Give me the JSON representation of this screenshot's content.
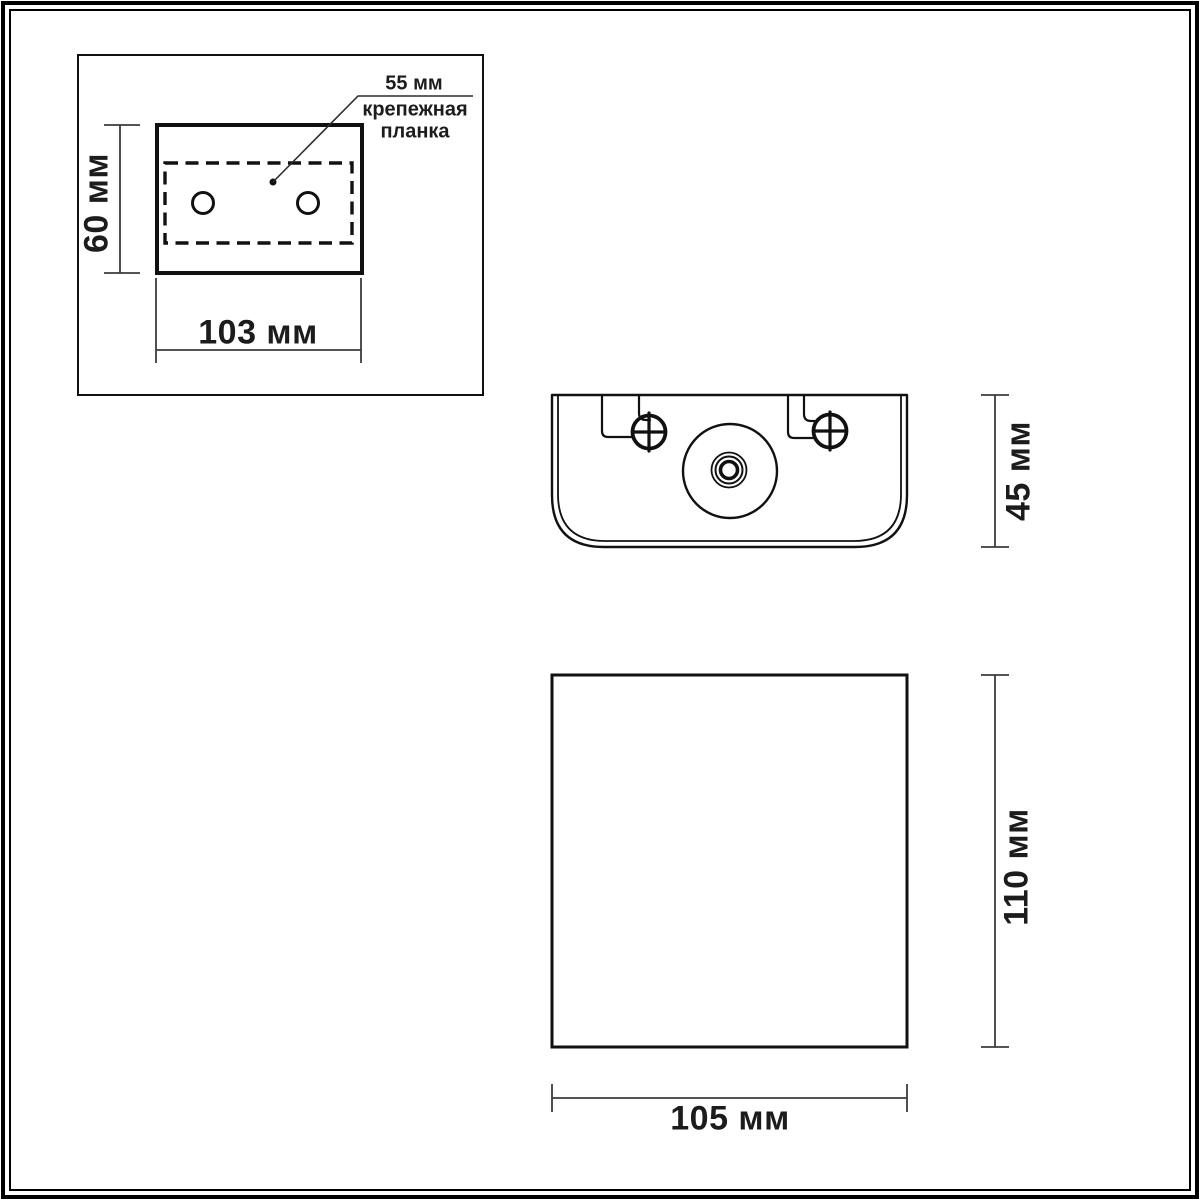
{
  "page": {
    "background": "#ffffff",
    "line_color": "#111111",
    "dim_color": "#3c3c3c"
  },
  "plate_view": {
    "height_label": "60 мм",
    "width_label": "103 мм",
    "callout_dim": "55 мм",
    "callout_line1": "крепежная",
    "callout_line2": "планка"
  },
  "top_view": {
    "height_label": "45 мм"
  },
  "front_view": {
    "height_label": "110 мм",
    "width_label": "105 мм"
  }
}
